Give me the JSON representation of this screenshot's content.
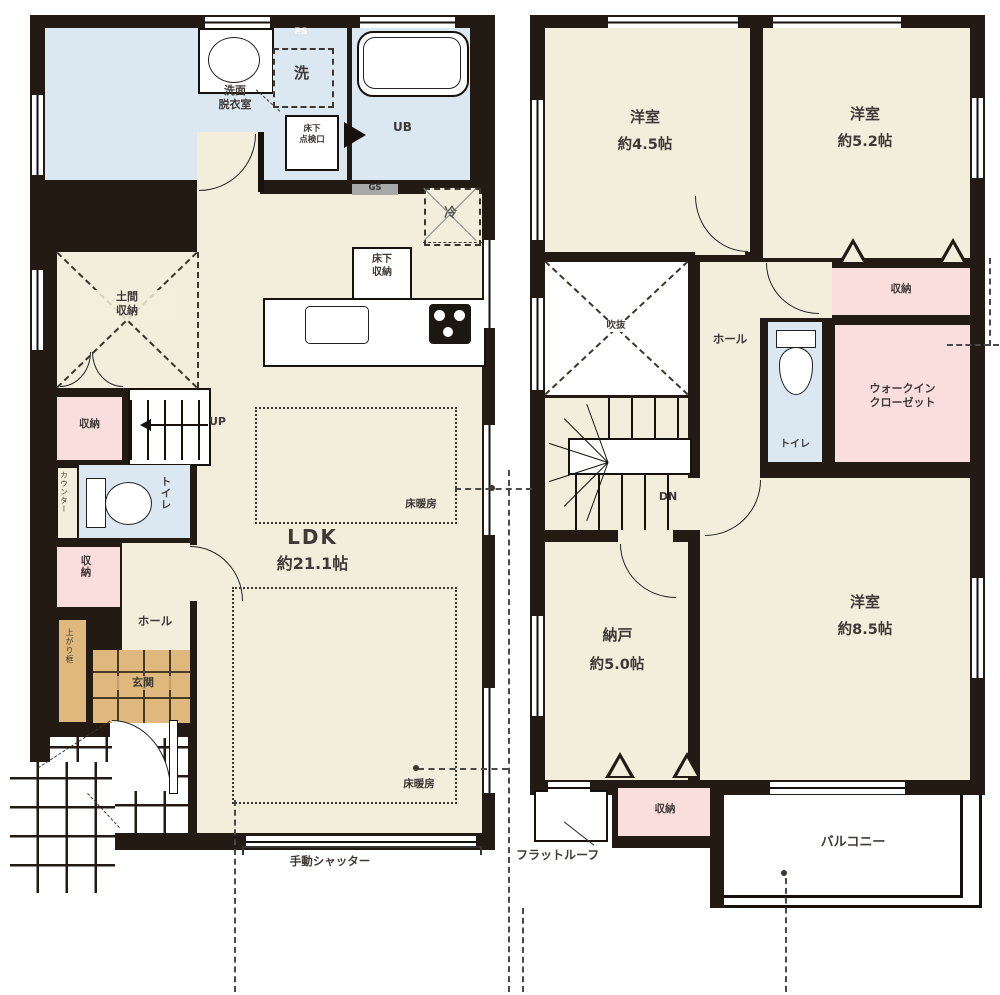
{
  "colors": {
    "wall": "#221a13",
    "floor": "#f3eedb",
    "water": "#dbe7f1",
    "closet": "#fadedd",
    "tile": "#dfb87d",
    "text": "#3f3a37",
    "guide": "#4a4a4a",
    "gs_badge": "#a8a8a8"
  },
  "floor1": {
    "labels": {
      "ps": "PS",
      "washroom": "洗面\n脱衣室",
      "washer": "洗",
      "inspection_hatch": "床下\n点検口",
      "unit_bath": "UB",
      "gas": "GS",
      "fridge": "冷",
      "underfloor_storage": "床下\n収納",
      "doma_storage": "土間\n収納",
      "storage_upper": "収納",
      "stairs_up": "UP",
      "counter": "カウンター",
      "toilet": "トイレ",
      "storage_lower": "収納",
      "hall": "ホール",
      "entrance": "玄関",
      "agari_kamachi": "上がり框",
      "ldk_name": "LDK",
      "ldk_size": "約21.1帖",
      "floor_heating": "床暖房",
      "shutter": "手動シャッター"
    }
  },
  "floor2": {
    "labels": {
      "bedroom_a_name": "洋室",
      "bedroom_a_size": "約4.5帖",
      "bedroom_b_name": "洋室",
      "bedroom_b_size": "約5.2帖",
      "atrium_void": "吹抜",
      "hall": "ホール",
      "storage_top": "収納",
      "toilet": "トイレ",
      "walk_in_closet": "ウォークイン\nクローゼット",
      "stairs_down": "DN",
      "storeroom_name": "納戸",
      "storeroom_size": "約5.0帖",
      "bedroom_c_name": "洋室",
      "bedroom_c_size": "約8.5帖",
      "storage_bottom": "収納",
      "flat_roof": "フラットルーフ",
      "balcony": "バルコニー"
    }
  }
}
